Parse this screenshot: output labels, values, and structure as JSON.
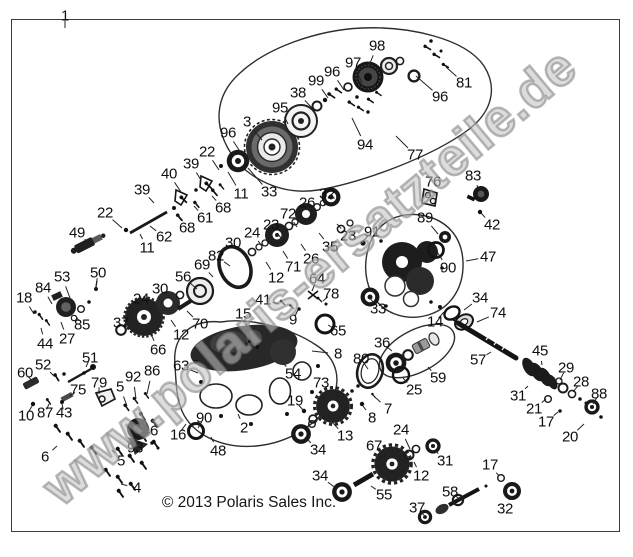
{
  "page": {
    "background": "#ffffff",
    "frame_color": "#3c3c3c",
    "line_color": "#1a1a1a",
    "label_color": "#0f0f0f",
    "watermark_color": "#9a9a9a"
  },
  "watermark": {
    "text": "www.polaris-ersatzteile.de"
  },
  "footer": {
    "copyright": "© 2013 Polaris Sales Inc."
  },
  "diagram": {
    "type": "exploded-parts-diagram",
    "callouts": [
      {
        "t": "1",
        "x": 65,
        "y": 16,
        "lx": 65,
        "ly": 28
      },
      {
        "t": "98",
        "x": 377,
        "y": 46,
        "lx": 368,
        "ly": 68
      },
      {
        "t": "97",
        "x": 353,
        "y": 63,
        "lx": 362,
        "ly": 83
      },
      {
        "t": "96",
        "x": 332,
        "y": 72,
        "lx": 344,
        "ly": 90
      },
      {
        "t": "99",
        "x": 316,
        "y": 81,
        "lx": 328,
        "ly": 98
      },
      {
        "t": "38",
        "x": 298,
        "y": 93,
        "lx": 312,
        "ly": 108
      },
      {
        "t": "95",
        "x": 280,
        "y": 108,
        "lx": 288,
        "ly": 124
      },
      {
        "t": "3",
        "x": 247,
        "y": 122,
        "lx": 262,
        "ly": 140
      },
      {
        "t": "96",
        "x": 228,
        "y": 133,
        "lx": 241,
        "ly": 153
      },
      {
        "t": "94",
        "x": 365,
        "y": 145,
        "lx": 352,
        "ly": 118
      },
      {
        "t": "96",
        "x": 440,
        "y": 97,
        "lx": 416,
        "ly": 76
      },
      {
        "t": "81",
        "x": 464,
        "y": 83,
        "lx": 446,
        "ly": 67
      },
      {
        "t": "77",
        "x": 415,
        "y": 155,
        "lx": 396,
        "ly": 136
      },
      {
        "t": "33",
        "x": 269,
        "y": 192,
        "lx": 248,
        "ly": 168
      },
      {
        "t": "11",
        "x": 241,
        "y": 194,
        "lx": 228,
        "ly": 172
      },
      {
        "t": "22",
        "x": 207,
        "y": 152,
        "lx": 219,
        "ly": 170
      },
      {
        "t": "39",
        "x": 191,
        "y": 164,
        "lx": 201,
        "ly": 180
      },
      {
        "t": "40",
        "x": 169,
        "y": 174,
        "lx": 181,
        "ly": 192
      },
      {
        "t": "39",
        "x": 142,
        "y": 190,
        "lx": 154,
        "ly": 203
      },
      {
        "t": "22",
        "x": 105,
        "y": 213,
        "lx": 122,
        "ly": 228
      },
      {
        "t": "49",
        "x": 77,
        "y": 233,
        "lx": 88,
        "ly": 242
      },
      {
        "t": "11",
        "x": 147,
        "y": 248,
        "lx": 140,
        "ly": 234
      },
      {
        "t": "62",
        "x": 164,
        "y": 237,
        "lx": 150,
        "ly": 226
      },
      {
        "t": "68",
        "x": 187,
        "y": 228,
        "lx": 177,
        "ly": 215
      },
      {
        "t": "61",
        "x": 205,
        "y": 218,
        "lx": 194,
        "ly": 206
      },
      {
        "t": "68",
        "x": 223,
        "y": 208,
        "lx": 212,
        "ly": 196
      },
      {
        "t": "26",
        "x": 307,
        "y": 203,
        "lx": 297,
        "ly": 216
      },
      {
        "t": "32",
        "x": 327,
        "y": 194,
        "lx": 324,
        "ly": 206
      },
      {
        "t": "72",
        "x": 288,
        "y": 214,
        "lx": 297,
        "ly": 227
      },
      {
        "t": "23",
        "x": 271,
        "y": 225,
        "lx": 281,
        "ly": 238
      },
      {
        "t": "24",
        "x": 252,
        "y": 233,
        "lx": 262,
        "ly": 246
      },
      {
        "t": "30",
        "x": 233,
        "y": 243,
        "lx": 245,
        "ly": 256
      },
      {
        "t": "82",
        "x": 216,
        "y": 256,
        "lx": 230,
        "ly": 266
      },
      {
        "t": "69",
        "x": 202,
        "y": 265,
        "lx": 213,
        "ly": 277
      },
      {
        "t": "56",
        "x": 183,
        "y": 277,
        "lx": 197,
        "ly": 289
      },
      {
        "t": "30",
        "x": 160,
        "y": 289,
        "lx": 172,
        "ly": 300
      },
      {
        "t": "24",
        "x": 141,
        "y": 299,
        "lx": 153,
        "ly": 310
      },
      {
        "t": "37",
        "x": 121,
        "y": 323,
        "lx": 130,
        "ly": 329
      },
      {
        "t": "66",
        "x": 158,
        "y": 350,
        "lx": 151,
        "ly": 334
      },
      {
        "t": "12",
        "x": 181,
        "y": 335,
        "lx": 171,
        "ly": 320
      },
      {
        "t": "70",
        "x": 200,
        "y": 324,
        "lx": 187,
        "ly": 311
      },
      {
        "t": "12",
        "x": 276,
        "y": 278,
        "lx": 266,
        "ly": 262
      },
      {
        "t": "71",
        "x": 293,
        "y": 267,
        "lx": 283,
        "ly": 251
      },
      {
        "t": "26",
        "x": 311,
        "y": 259,
        "lx": 301,
        "ly": 244
      },
      {
        "t": "35",
        "x": 330,
        "y": 247,
        "lx": 319,
        "ly": 233
      },
      {
        "t": "23",
        "x": 348,
        "y": 236,
        "lx": 337,
        "ly": 224
      },
      {
        "t": "91",
        "x": 372,
        "y": 232,
        "lx": 363,
        "ly": 241
      },
      {
        "t": "89",
        "x": 425,
        "y": 218,
        "lx": 438,
        "ly": 234
      },
      {
        "t": "90",
        "x": 448,
        "y": 268,
        "lx": 437,
        "ly": 252
      },
      {
        "t": "47",
        "x": 488,
        "y": 257,
        "lx": 466,
        "ly": 261
      },
      {
        "t": "76",
        "x": 433,
        "y": 182,
        "lx": 429,
        "ly": 196
      },
      {
        "t": "83",
        "x": 473,
        "y": 176,
        "lx": 479,
        "ly": 190
      },
      {
        "t": "42",
        "x": 492,
        "y": 225,
        "lx": 481,
        "ly": 213
      },
      {
        "t": "33",
        "x": 378,
        "y": 309,
        "lx": 370,
        "ly": 298
      },
      {
        "t": "14",
        "x": 435,
        "y": 322,
        "lx": 444,
        "ly": 312
      },
      {
        "t": "34",
        "x": 480,
        "y": 298,
        "lx": 464,
        "ly": 310
      },
      {
        "t": "74",
        "x": 498,
        "y": 313,
        "lx": 477,
        "ly": 322
      },
      {
        "t": "57",
        "x": 478,
        "y": 360,
        "lx": 491,
        "ly": 352
      },
      {
        "t": "45",
        "x": 540,
        "y": 351,
        "lx": 542,
        "ly": 365
      },
      {
        "t": "31",
        "x": 518,
        "y": 396,
        "lx": 528,
        "ly": 386
      },
      {
        "t": "29",
        "x": 566,
        "y": 368,
        "lx": 560,
        "ly": 380
      },
      {
        "t": "28",
        "x": 581,
        "y": 382,
        "lx": 573,
        "ly": 392
      },
      {
        "t": "21",
        "x": 534,
        "y": 409,
        "lx": 546,
        "ly": 399
      },
      {
        "t": "17",
        "x": 546,
        "y": 422,
        "lx": 558,
        "ly": 412
      },
      {
        "t": "88",
        "x": 599,
        "y": 394,
        "lx": 593,
        "ly": 404
      },
      {
        "t": "20",
        "x": 570,
        "y": 437,
        "lx": 584,
        "ly": 424
      },
      {
        "t": "15",
        "x": 243,
        "y": 314,
        "lx": 251,
        "ly": 340
      },
      {
        "t": "41",
        "x": 263,
        "y": 300,
        "lx": 279,
        "ly": 304
      },
      {
        "t": "9",
        "x": 293,
        "y": 320,
        "lx": 298,
        "ly": 310
      },
      {
        "t": "64",
        "x": 317,
        "y": 279,
        "lx": 312,
        "ly": 291
      },
      {
        "t": "78",
        "x": 331,
        "y": 294,
        "lx": 323,
        "ly": 301
      },
      {
        "t": "65",
        "x": 338,
        "y": 331,
        "lx": 328,
        "ly": 325
      },
      {
        "t": "8",
        "x": 338,
        "y": 354,
        "lx": 312,
        "ly": 351
      },
      {
        "t": "80",
        "x": 361,
        "y": 359,
        "lx": 368,
        "ly": 369
      },
      {
        "t": "54",
        "x": 293,
        "y": 374,
        "lx": 283,
        "ly": 363
      },
      {
        "t": "73",
        "x": 321,
        "y": 383,
        "lx": 330,
        "ly": 396
      },
      {
        "t": "7",
        "x": 388,
        "y": 409,
        "lx": 376,
        "ly": 398
      },
      {
        "t": "8",
        "x": 372,
        "y": 418,
        "lx": 363,
        "ly": 406
      },
      {
        "t": "36",
        "x": 382,
        "y": 343,
        "lx": 392,
        "ly": 351
      },
      {
        "t": "59",
        "x": 438,
        "y": 378,
        "lx": 428,
        "ly": 367
      },
      {
        "t": "25",
        "x": 414,
        "y": 390,
        "lx": 403,
        "ly": 378
      },
      {
        "t": "19",
        "x": 295,
        "y": 401,
        "lx": 304,
        "ly": 411
      },
      {
        "t": "13",
        "x": 345,
        "y": 436,
        "lx": 331,
        "ly": 421
      },
      {
        "t": "34",
        "x": 318,
        "y": 450,
        "lx": 305,
        "ly": 437
      },
      {
        "t": "24",
        "x": 401,
        "y": 430,
        "lx": 410,
        "ly": 449
      },
      {
        "t": "67",
        "x": 374,
        "y": 446,
        "lx": 387,
        "ly": 457
      },
      {
        "t": "31",
        "x": 445,
        "y": 461,
        "lx": 435,
        "ly": 450
      },
      {
        "t": "12",
        "x": 421,
        "y": 476,
        "lx": 414,
        "ly": 462
      },
      {
        "t": "34",
        "x": 320,
        "y": 476,
        "lx": 337,
        "ly": 489
      },
      {
        "t": "55",
        "x": 384,
        "y": 495,
        "lx": 371,
        "ly": 486
      },
      {
        "t": "58",
        "x": 450,
        "y": 492,
        "lx": 461,
        "ly": 500
      },
      {
        "t": "37",
        "x": 417,
        "y": 508,
        "lx": 424,
        "ly": 515
      },
      {
        "t": "17",
        "x": 490,
        "y": 465,
        "lx": 499,
        "ly": 476
      },
      {
        "t": "32",
        "x": 505,
        "y": 509,
        "lx": 511,
        "ly": 496
      },
      {
        "t": "18",
        "x": 24,
        "y": 298,
        "lx": 34,
        "ly": 314
      },
      {
        "t": "84",
        "x": 43,
        "y": 288,
        "lx": 52,
        "ly": 304
      },
      {
        "t": "53",
        "x": 62,
        "y": 277,
        "lx": 70,
        "ly": 298
      },
      {
        "t": "50",
        "x": 98,
        "y": 273,
        "lx": 96,
        "ly": 286
      },
      {
        "t": "85",
        "x": 82,
        "y": 325,
        "lx": 75,
        "ly": 315
      },
      {
        "t": "27",
        "x": 67,
        "y": 339,
        "lx": 61,
        "ly": 322
      },
      {
        "t": "44",
        "x": 45,
        "y": 344,
        "lx": 41,
        "ly": 328
      },
      {
        "t": "52",
        "x": 43,
        "y": 365,
        "lx": 54,
        "ly": 376
      },
      {
        "t": "60",
        "x": 25,
        "y": 373,
        "lx": 33,
        "ly": 382
      },
      {
        "t": "51",
        "x": 90,
        "y": 358,
        "lx": 86,
        "ly": 367
      },
      {
        "t": "75",
        "x": 78,
        "y": 390,
        "lx": 70,
        "ly": 396
      },
      {
        "t": "79",
        "x": 99,
        "y": 383,
        "lx": 99,
        "ly": 394
      },
      {
        "t": "10",
        "x": 26,
        "y": 416,
        "lx": 32,
        "ly": 406
      },
      {
        "t": "87",
        "x": 45,
        "y": 413,
        "lx": 49,
        "ly": 404
      },
      {
        "t": "43",
        "x": 64,
        "y": 413,
        "lx": 62,
        "ly": 404
      },
      {
        "t": "6",
        "x": 45,
        "y": 457,
        "lx": 57,
        "ly": 446
      },
      {
        "t": "5",
        "x": 120,
        "y": 387,
        "lx": 127,
        "ly": 406
      },
      {
        "t": "92",
        "x": 133,
        "y": 377,
        "lx": 136,
        "ly": 399
      },
      {
        "t": "86",
        "x": 152,
        "y": 371,
        "lx": 147,
        "ly": 394
      },
      {
        "t": "63",
        "x": 181,
        "y": 366,
        "lx": 198,
        "ly": 373
      },
      {
        "t": "46",
        "x": 150,
        "y": 431,
        "lx": 141,
        "ly": 429
      },
      {
        "t": "93",
        "x": 135,
        "y": 448,
        "lx": 127,
        "ly": 441
      },
      {
        "t": "5",
        "x": 121,
        "y": 461,
        "lx": 112,
        "ly": 450
      },
      {
        "t": "4",
        "x": 137,
        "y": 488,
        "lx": 121,
        "ly": 484
      },
      {
        "t": "16",
        "x": 178,
        "y": 435,
        "lx": 186,
        "ly": 424
      },
      {
        "t": "90",
        "x": 204,
        "y": 418,
        "lx": 198,
        "ly": 428
      },
      {
        "t": "48",
        "x": 218,
        "y": 451,
        "lx": 211,
        "ly": 437
      },
      {
        "t": "2",
        "x": 244,
        "y": 428,
        "lx": 238,
        "ly": 414
      }
    ]
  }
}
